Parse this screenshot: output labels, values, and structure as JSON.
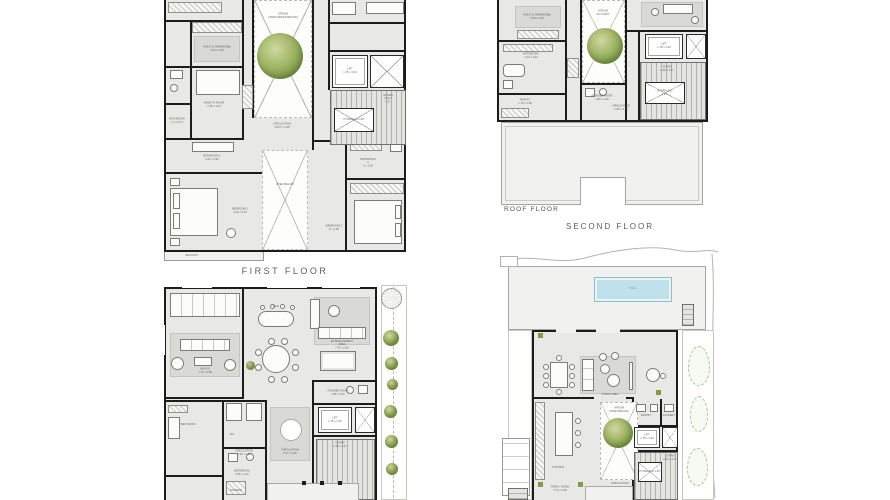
{
  "page": {
    "background": "#ffffff"
  },
  "captions": {
    "first_floor": "FIRST FLOOR",
    "roof_floor": "ROOF FLOOR",
    "second_floor": "SECOND FLOOR"
  },
  "colors": {
    "wall": "#1c1c1c",
    "floor": "#e8e8e6",
    "void": "#fdfdfc",
    "tree": "#85a24e",
    "pool_water": "#bfe1ec",
    "roof_slab": "#f1f1ef",
    "caption_text": "#5c5c58"
  },
  "plans": {
    "fl": {
      "title": "FIRST FLOOR",
      "labels": {
        "atrium": "ATRIUM\n(OPEN ABOVE BELOW)",
        "wardrobe": "WALK IN WARDROBE\n4.03 x 3.30",
        "nanny": "NANNY'S ROOM\n2.98 x 4.30",
        "bath_small": "BATHROOM\n1.4 x 2.71",
        "bath1": "BATHROOM 1\n2.02 x 4.02",
        "bed1": "BEDROOM 1\n4.46 x 5.46",
        "open_below": "OPEN BELOW",
        "bed2": "BEDROOM 2\n5 x 4.06",
        "bath2": "BATHROOM 2\n3 x 2.06",
        "balcony": "BALCONY",
        "lift": "LIFT\n1.78 x 2.00",
        "stairs": "STAIRS\n2.49 x 4.27",
        "hydraulic": "HYDRAULIC LIFT",
        "circulation": "CIRCULATION\n20.87 x 1.98"
      }
    },
    "rf": {
      "title": "ROOF FLOOR",
      "labels": {
        "wardrobe": "WALK IN WARDROBE\n3.95 x 3.30",
        "bathroom": "BATHROOM\n4.12 x 4.43",
        "atrium": "ATRIUM\nSKYLIGHT",
        "powder": "POWDER ROOM\n1.83 x 2.06",
        "pantry": "PANTRY\n1.78 x 2.08",
        "lift": "LIFT\n1.78 x 2.00",
        "stairs": "STAIRS\n2.49 x 4.27",
        "hydraulic": "HYDRAULIC LIFT",
        "circulation": "CIRCULATION\n1.83 x 4.08"
      }
    },
    "gf": {
      "labels": {
        "majlis": "MAJLIS\n7.71 x 4.98",
        "bar": "BAR",
        "entertainment": "ENTERTAINMENT AREA\n7.07 x 6.00",
        "powder": "POWDER ROOM\n1.85 x 2.62",
        "wet_room": "WET ROOM",
        "wc": "WC",
        "bathroom": "BATHROOM\n2.06 x 1.22",
        "shower": "SHOWER",
        "circ_small": "CIRCULATION\n2.96 x 1.22",
        "circulation": "CIRCULATION\n8.77 x 4.98",
        "lift": "LIFT\n1.78 x 2.00",
        "stairs": "STAIRS\n2.49 x 4.27"
      }
    },
    "sf": {
      "title": "SECOND FLOOR",
      "labels": {
        "pool": "POOL",
        "living": "LIVING AREA",
        "family": "FAMILY ROOM\n7.71 x 4.98",
        "atrium": "ATRIUM\n(OPEN BELOW)",
        "kitchen": "KITCHEN",
        "pantry": "PANTRY",
        "laundry": "LAUNDRY",
        "lift": "LIFT\n1.78 x 2.00",
        "stairs": "STAIRS\n2.49 x 4.27",
        "hydraulic": "HYDRAULIC LIFT",
        "circulation": "CIRCULATION"
      }
    }
  }
}
